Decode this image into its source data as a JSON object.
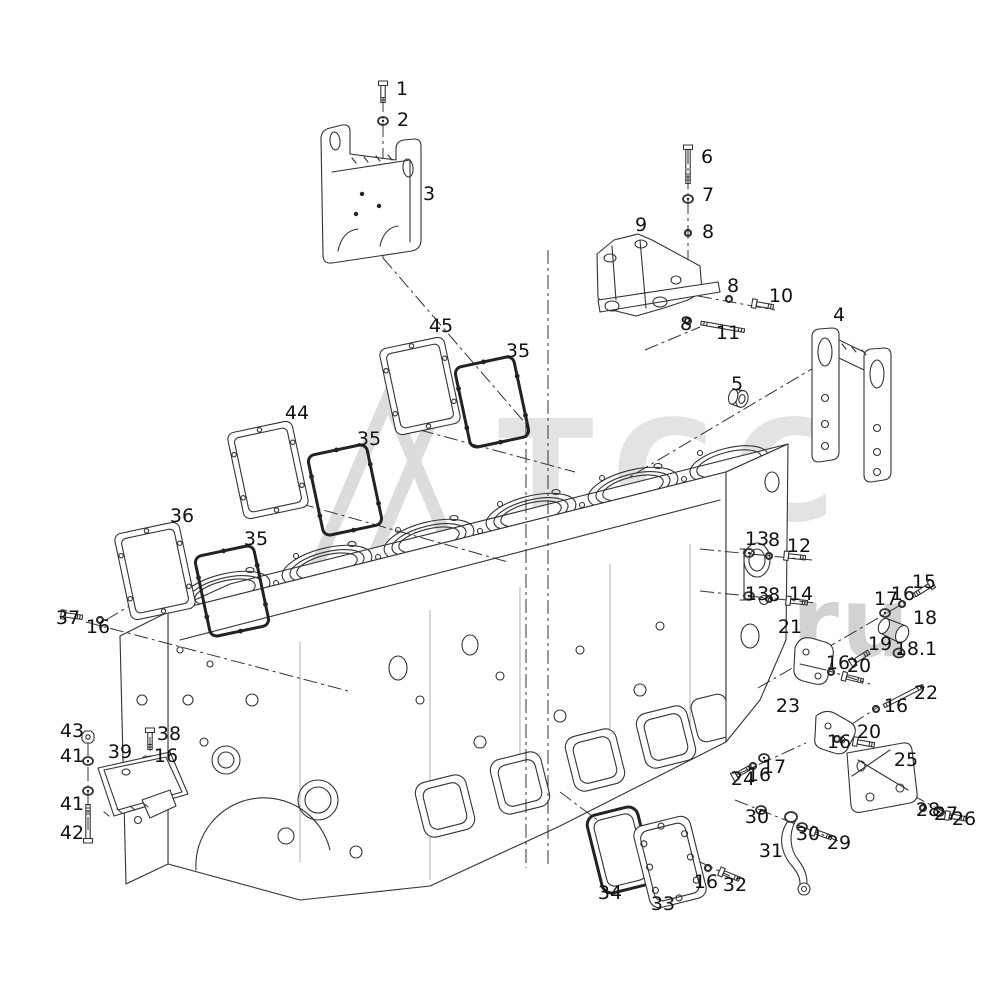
{
  "page": {
    "background_color": "#ffffff"
  },
  "watermark": {
    "text": "www.tss.ru",
    "logo_text": "ТСС",
    "color": "#d6d6d6",
    "logo": "triangle-logo"
  },
  "diagram": {
    "type": "exploded-parts-diagram",
    "subject": "Six-cylinder diesel engine cylinder block with mounting brackets, side covers, gaskets and fasteners",
    "line_color": "#333333",
    "label_color": "#111111",
    "callouts": [
      {
        "part": "1",
        "x": 402,
        "y": 95
      },
      {
        "part": "2",
        "x": 403,
        "y": 126
      },
      {
        "part": "3",
        "x": 429,
        "y": 200
      },
      {
        "part": "45",
        "x": 441,
        "y": 332
      },
      {
        "part": "35",
        "x": 518,
        "y": 357
      },
      {
        "part": "44",
        "x": 297,
        "y": 419
      },
      {
        "part": "35",
        "x": 369,
        "y": 445
      },
      {
        "part": "36",
        "x": 182,
        "y": 522
      },
      {
        "part": "35",
        "x": 256,
        "y": 545
      },
      {
        "part": "37",
        "x": 68,
        "y": 624
      },
      {
        "part": "16",
        "x": 98,
        "y": 633
      },
      {
        "part": "6",
        "x": 707,
        "y": 163
      },
      {
        "part": "7",
        "x": 708,
        "y": 201
      },
      {
        "part": "8",
        "x": 708,
        "y": 238
      },
      {
        "part": "9",
        "x": 641,
        "y": 231
      },
      {
        "part": "8",
        "x": 733,
        "y": 292
      },
      {
        "part": "10",
        "x": 781,
        "y": 302
      },
      {
        "part": "8",
        "x": 686,
        "y": 330
      },
      {
        "part": "11",
        "x": 728,
        "y": 339
      },
      {
        "part": "4",
        "x": 839,
        "y": 321
      },
      {
        "part": "5",
        "x": 737,
        "y": 390
      },
      {
        "part": "13",
        "x": 757,
        "y": 545
      },
      {
        "part": "8",
        "x": 774,
        "y": 546
      },
      {
        "part": "12",
        "x": 799,
        "y": 552
      },
      {
        "part": "13",
        "x": 757,
        "y": 600
      },
      {
        "part": "8",
        "x": 774,
        "y": 601
      },
      {
        "part": "14",
        "x": 801,
        "y": 600
      },
      {
        "part": "15",
        "x": 924,
        "y": 588
      },
      {
        "part": "16",
        "x": 903,
        "y": 600
      },
      {
        "part": "17",
        "x": 886,
        "y": 605
      },
      {
        "part": "18",
        "x": 925,
        "y": 624
      },
      {
        "part": "19",
        "x": 880,
        "y": 650
      },
      {
        "part": "18.1",
        "x": 916,
        "y": 655
      },
      {
        "part": "20",
        "x": 859,
        "y": 672
      },
      {
        "part": "21",
        "x": 790,
        "y": 633
      },
      {
        "part": "16",
        "x": 838,
        "y": 669
      },
      {
        "part": "22",
        "x": 926,
        "y": 699
      },
      {
        "part": "16",
        "x": 896,
        "y": 712
      },
      {
        "part": "23",
        "x": 788,
        "y": 712
      },
      {
        "part": "20",
        "x": 869,
        "y": 738
      },
      {
        "part": "16",
        "x": 839,
        "y": 748
      },
      {
        "part": "17",
        "x": 774,
        "y": 773
      },
      {
        "part": "24",
        "x": 743,
        "y": 785
      },
      {
        "part": "16",
        "x": 759,
        "y": 781
      },
      {
        "part": "25",
        "x": 906,
        "y": 766
      },
      {
        "part": "28",
        "x": 928,
        "y": 816
      },
      {
        "part": "27",
        "x": 946,
        "y": 820
      },
      {
        "part": "26",
        "x": 964,
        "y": 825
      },
      {
        "part": "30",
        "x": 757,
        "y": 823
      },
      {
        "part": "30",
        "x": 808,
        "y": 840
      },
      {
        "part": "29",
        "x": 839,
        "y": 849
      },
      {
        "part": "31",
        "x": 771,
        "y": 857
      },
      {
        "part": "34",
        "x": 610,
        "y": 899
      },
      {
        "part": "33",
        "x": 663,
        "y": 910
      },
      {
        "part": "16",
        "x": 706,
        "y": 888
      },
      {
        "part": "32",
        "x": 735,
        "y": 891
      },
      {
        "part": "38",
        "x": 169,
        "y": 740
      },
      {
        "part": "16",
        "x": 166,
        "y": 762
      },
      {
        "part": "43",
        "x": 72,
        "y": 737
      },
      {
        "part": "41",
        "x": 72,
        "y": 762
      },
      {
        "part": "39",
        "x": 120,
        "y": 758
      },
      {
        "part": "41",
        "x": 72,
        "y": 810
      },
      {
        "part": "42",
        "x": 72,
        "y": 839
      }
    ]
  }
}
